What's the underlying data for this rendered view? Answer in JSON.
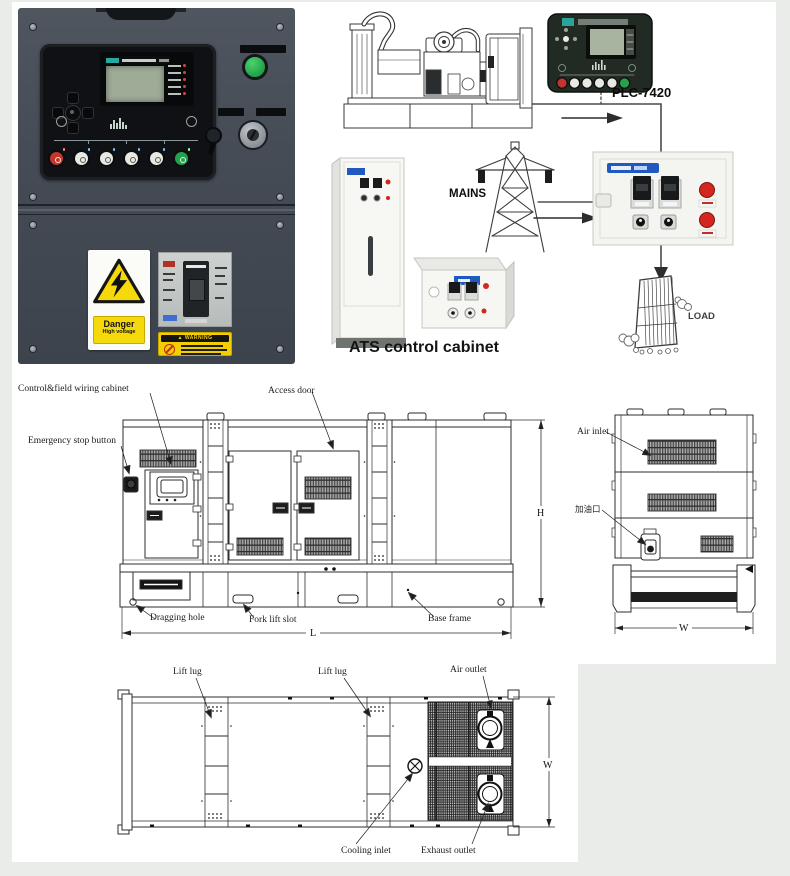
{
  "photo_panel": {
    "danger_sticker": {
      "line1": "Danger",
      "line2": "High voltage"
    },
    "warning_sticker": {
      "icon": "▲",
      "title": "WARNING"
    }
  },
  "flow_diagram": {
    "plc_label": "PLC-7420",
    "mains_label": "MAINS",
    "ats_caption": "ATS control cabinet",
    "load_label": "LOAD"
  },
  "engineering_drawings": {
    "side_view": {
      "control_cabinet_label": "Control&field wiring cabinet",
      "emergency_stop_label": "Emergency stop button",
      "access_door_label": "Access door",
      "dragging_hole_label": "Dragging hole",
      "fork_lift_slot_label": "Fork lift slot",
      "base_frame_label": "Base frame",
      "length_dim": "L",
      "height_dim": "H"
    },
    "end_view": {
      "air_inlet_label": "Air inlet",
      "fuel_filler_label": "加油口",
      "width_dim": "W"
    },
    "top_view": {
      "lift_lug_label_1": "Lift lug",
      "lift_lug_label_2": "Lift lug",
      "air_outlet_label": "Air outlet",
      "cooling_inlet_label": "Cooling inlet",
      "exhaust_outlet_label": "Exhaust outlet",
      "width_dim": "W"
    }
  },
  "colors": {
    "brand_blue": "#2059c0",
    "danger_yellow": "#f6d90a",
    "alert_red": "#d2261e",
    "indicator_green": "#22a24f"
  }
}
